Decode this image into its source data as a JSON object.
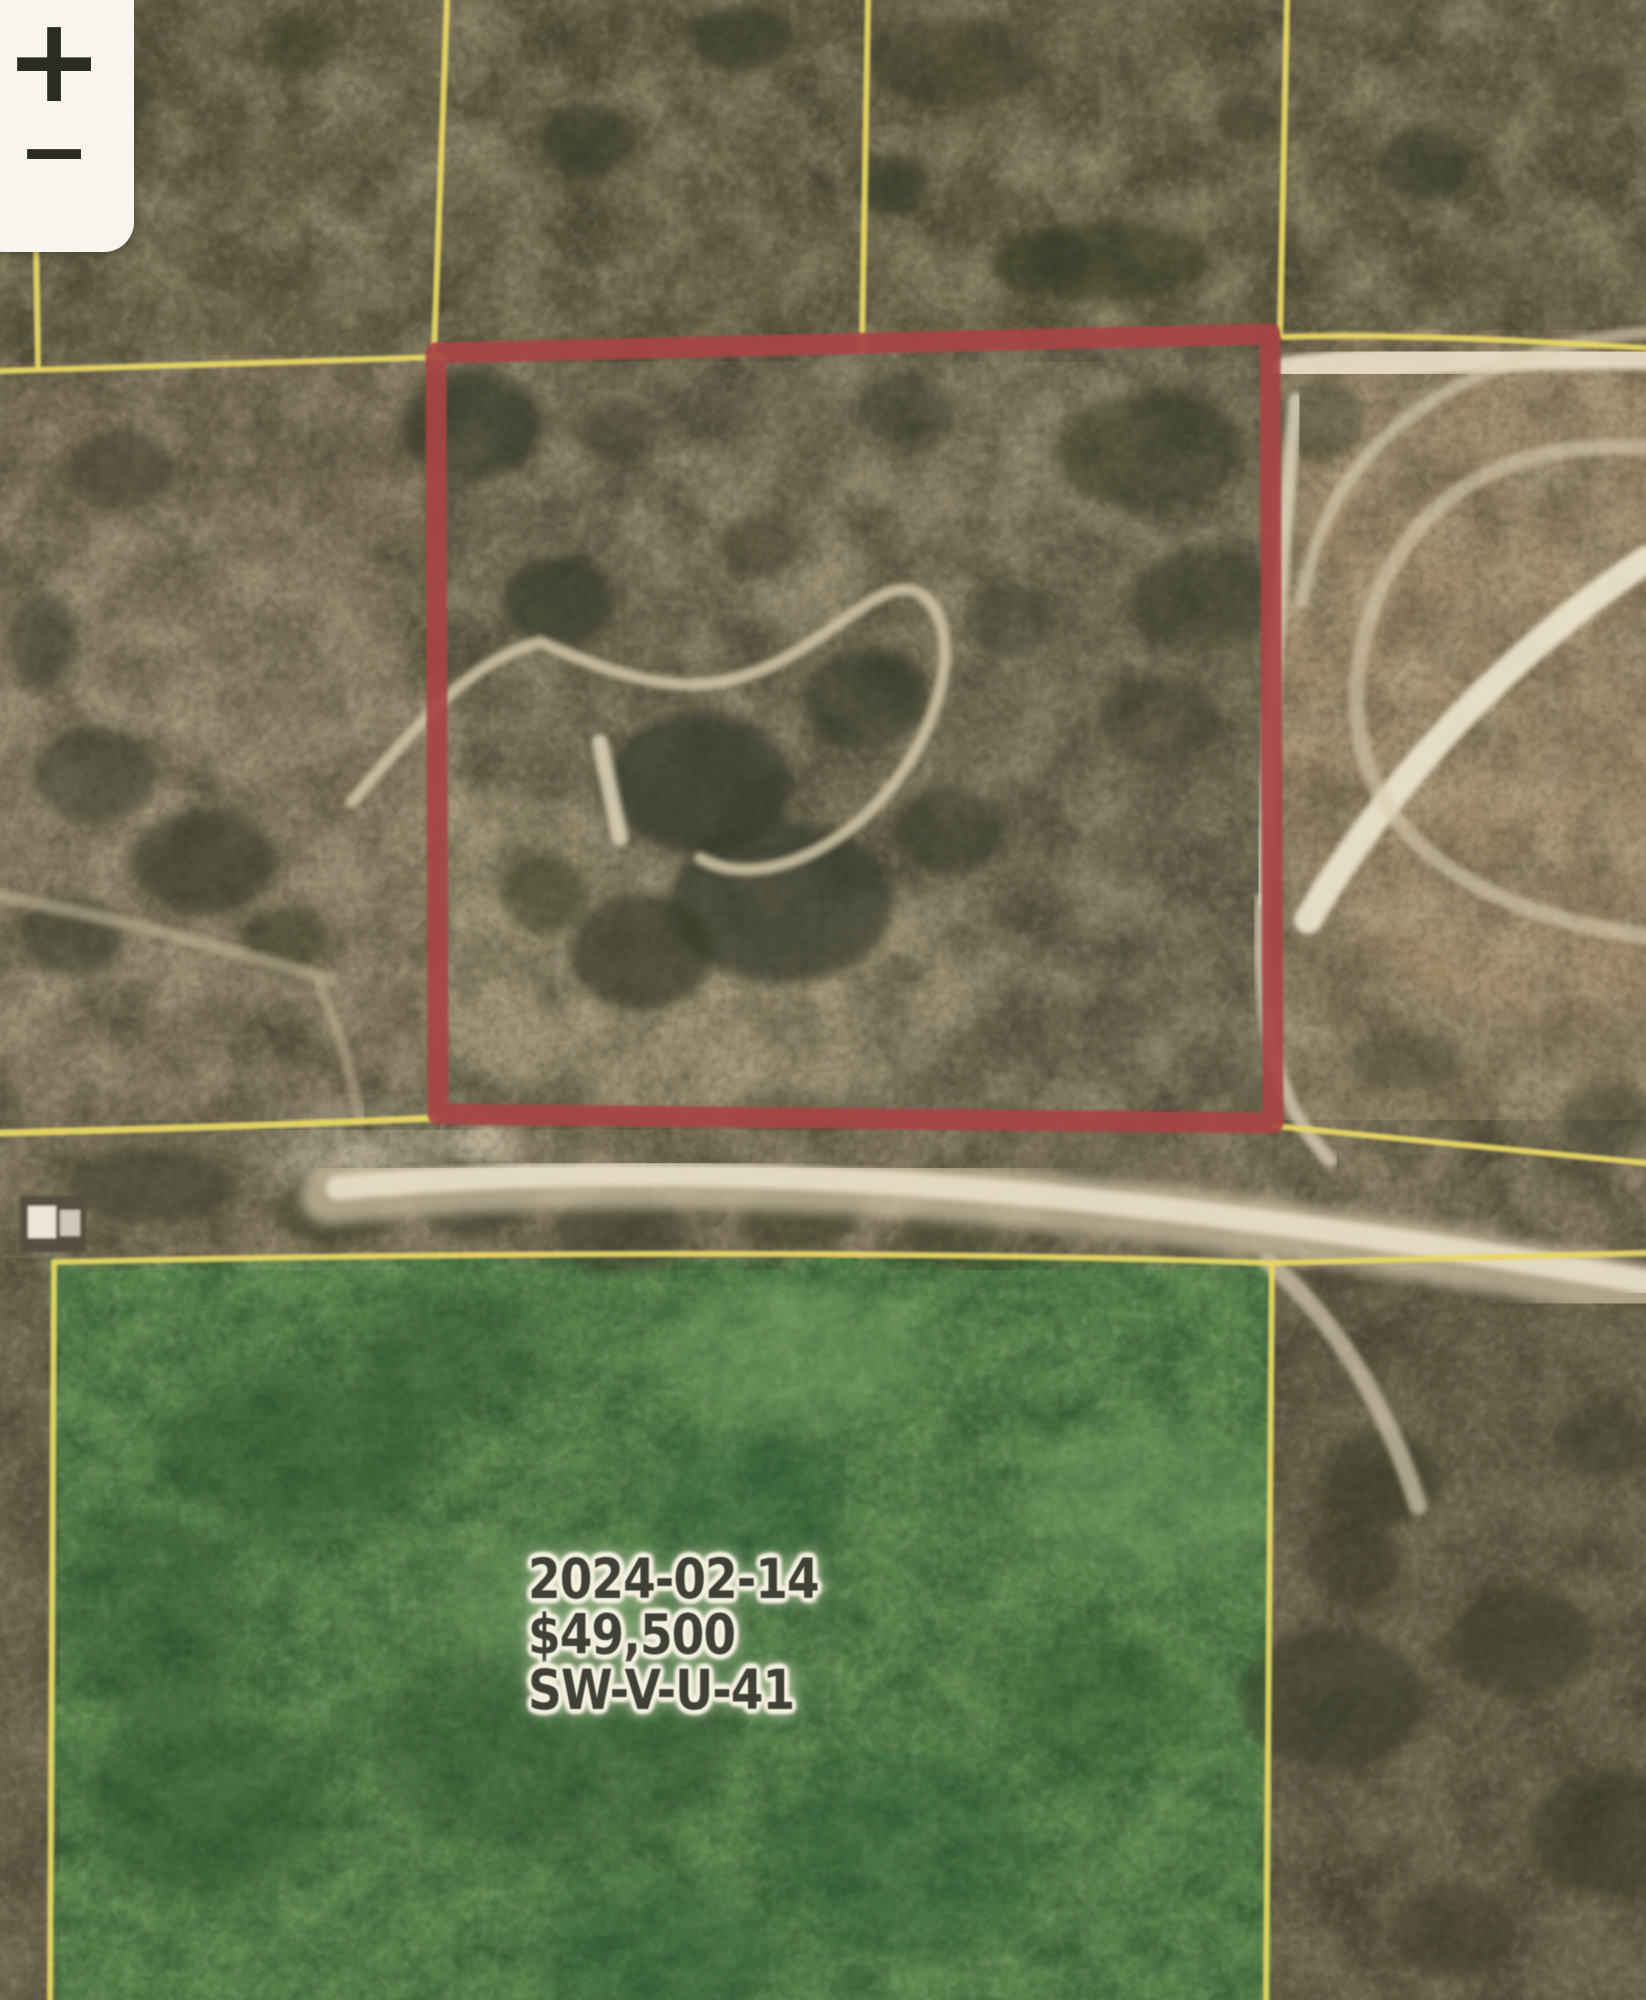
{
  "map": {
    "zoom_control": {
      "zoom_in": "+",
      "zoom_out": "−"
    },
    "parcel_label": {
      "date": "2024-02-14",
      "price": "$49,500",
      "parcel_id": "SW-V-U-41"
    },
    "colors": {
      "highlight_parcel_outline": "#a84545",
      "parcel_line_yellow": "#e7d765",
      "sold_parcel_green": "#55804a",
      "road_light": "#e8dfc7",
      "terrain_base": "#6f6952",
      "label_text": "#3f4036",
      "label_halo": "#f5f1e0",
      "control_bg": "#f8f5ee",
      "control_icon": "#2b2b23"
    }
  }
}
